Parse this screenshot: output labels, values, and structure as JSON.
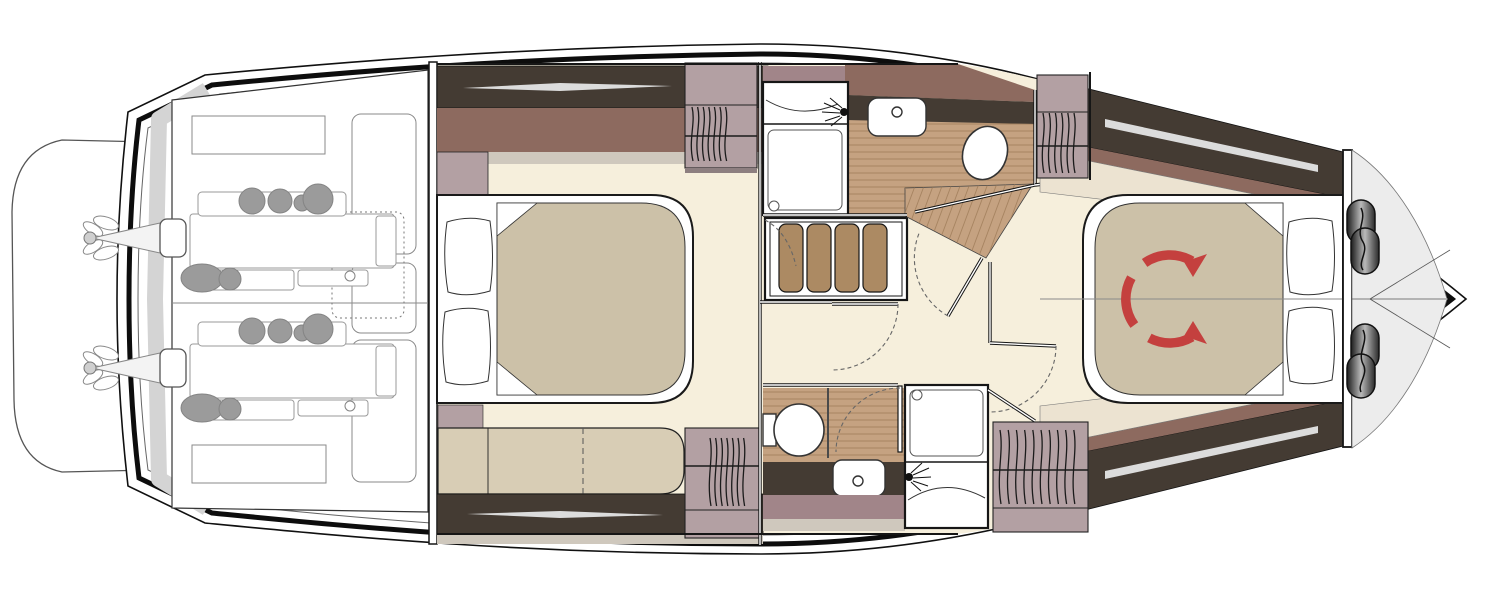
{
  "figure": {
    "kind": "yacht-lower-deck-floor-plan",
    "text_labels": []
  },
  "colors": {
    "paper": "#ffffff",
    "hull-line": "#101010",
    "deck-gray": "#d4d4d4",
    "foredeck": "#ececec",
    "floor-cream": "#f6efdc",
    "wood": "#c5a281",
    "wood-line": "#9c7a57",
    "tread": "#ac8a63",
    "cabinet-dark": "#443b33",
    "window-sliver": "#dcdcdc",
    "trim-redbrown": "#8d6a5f",
    "locker-mauve": "#b3a0a3",
    "band-mauve": "#a18589",
    "shelf-cream": "#ece3d1",
    "strip-gray": "#cfc8bd",
    "upholstery": "#d8cdb5",
    "mattress": "#ccc1a8",
    "arrow-red": "#c4403e",
    "engine-line": "#9a9a9a",
    "engine-fill": "#9b9b9b",
    "wall-black": "#161616"
  }
}
